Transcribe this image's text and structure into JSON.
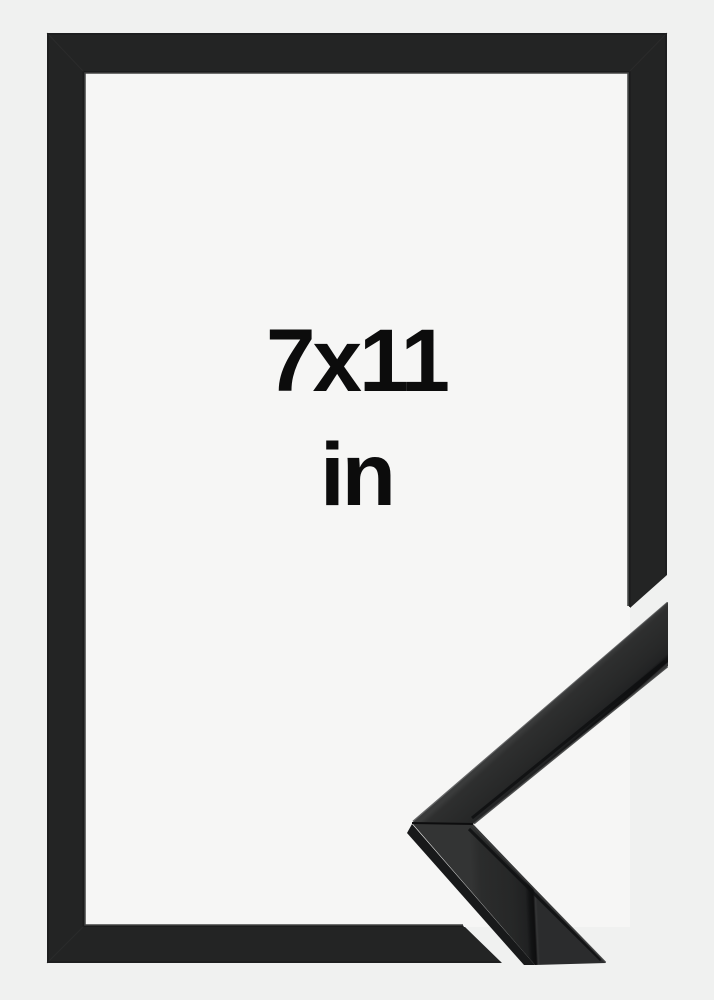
{
  "product_photo": {
    "size_label": "7x11",
    "unit_label": "in"
  },
  "colors": {
    "backdrop": "#f0f1f0",
    "opening_backdrop": "#f6f6f5",
    "frame_black": "#232424",
    "molding_charcoal": "#272828",
    "text": "#0c0c0c"
  }
}
